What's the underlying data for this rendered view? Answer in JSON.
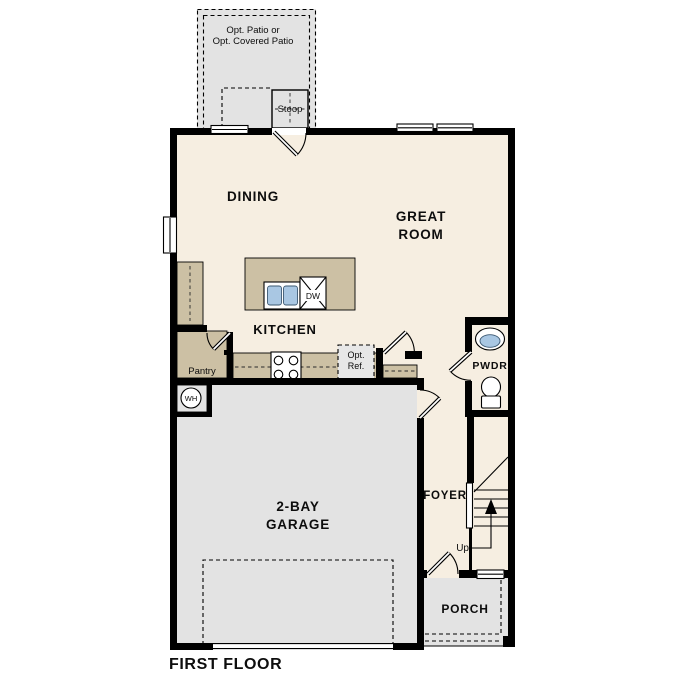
{
  "plan_title": "FIRST FLOOR",
  "labels": {
    "patio_line1": "Opt. Patio or",
    "patio_line2": "Opt. Covered Patio",
    "stoop": "Stoop",
    "dining": "DINING",
    "great_room_line1": "GREAT",
    "great_room_line2": "ROOM",
    "kitchen": "KITCHEN",
    "pantry": "Pantry",
    "opt_ref_line1": "Opt.",
    "opt_ref_line2": "Ref.",
    "dishwasher": "DW",
    "water_heater": "WH",
    "pwdr": "PWDR",
    "foyer": "FOYER",
    "up": "Up",
    "garage_line1": "2-BAY",
    "garage_line2": "GARAGE",
    "porch": "PORCH"
  },
  "colors": {
    "interior_floor": "#f6eee1",
    "concrete_floor": "#e3e3e3",
    "counter_tan": "#ccc0a4",
    "fixture_blue": "#a9c7e3",
    "wall_black": "#000000",
    "background": "#ffffff"
  }
}
